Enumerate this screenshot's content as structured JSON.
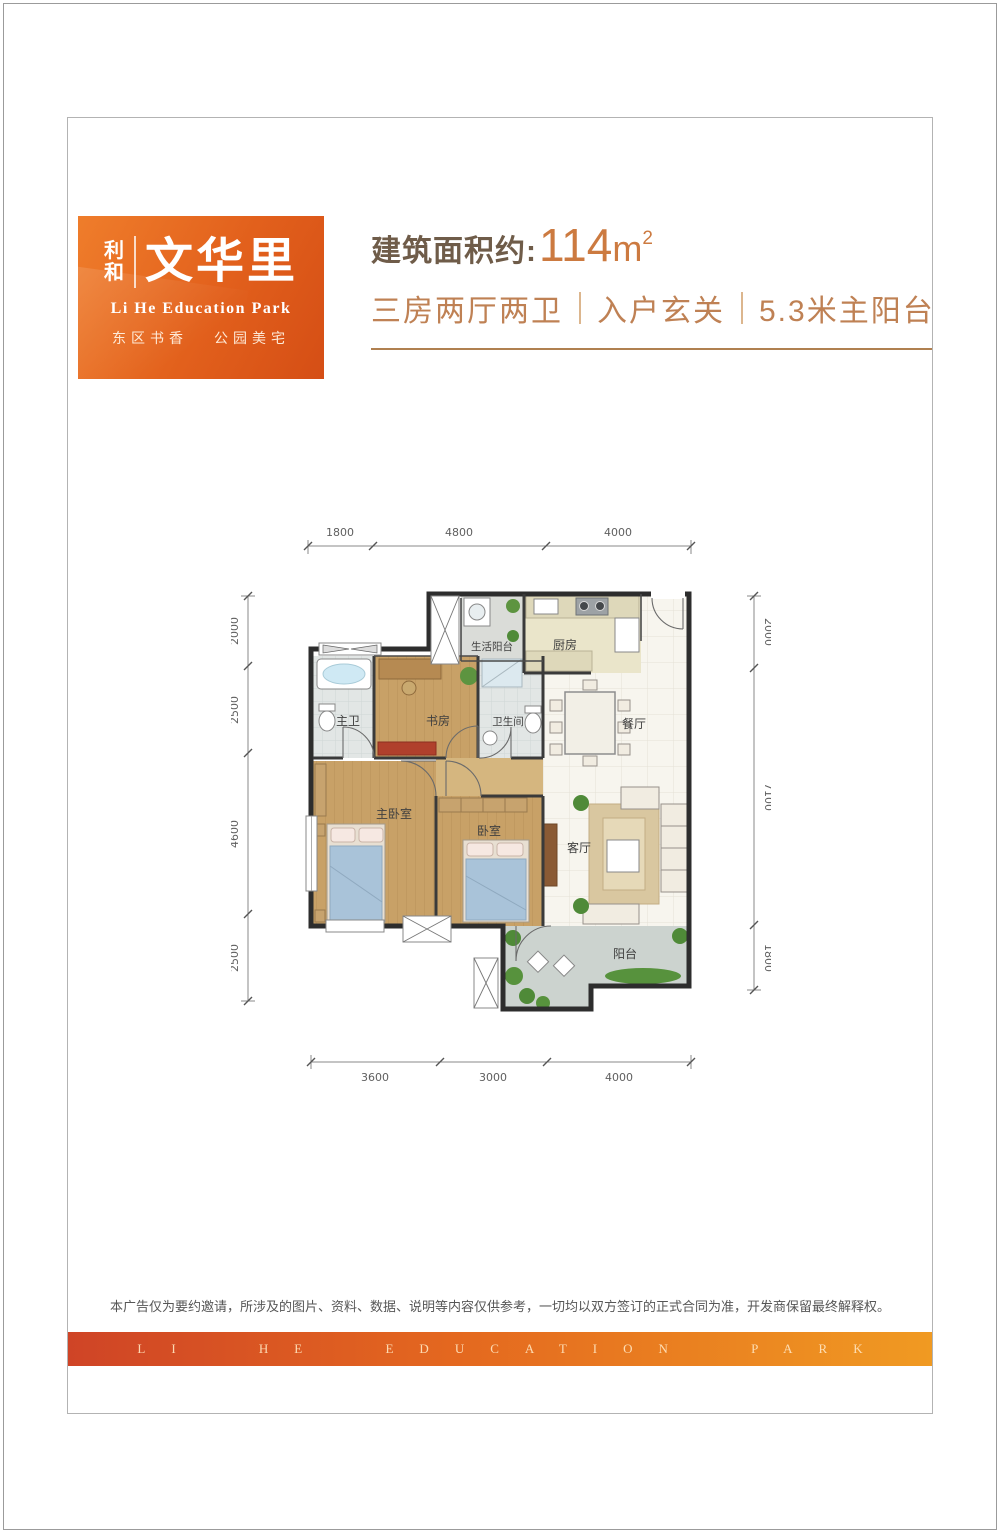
{
  "logo": {
    "prefix_chars": [
      "利",
      "和"
    ],
    "name": "文华里",
    "subtitle": "Li He Education Park",
    "tagline_left": "东区书香",
    "tagline_right": "公园美宅"
  },
  "header": {
    "area_label": "建筑面积约:",
    "area_value": "114",
    "area_unit_base": "m",
    "area_unit_sup": "2",
    "features": [
      "三房两厅两卫",
      "入户玄关",
      "5.3米主阳台"
    ]
  },
  "plan": {
    "rooms": {
      "service_balcony": "生活阳台",
      "kitchen": "厨房",
      "master_bath": "主卫",
      "study": "书房",
      "bathroom": "卫生间",
      "dining": "餐厅",
      "master_bedroom": "主卧室",
      "bedroom": "卧室",
      "living": "客厅",
      "balcony": "阳台"
    },
    "dims_top": [
      "1800",
      "4800",
      "4000"
    ],
    "dims_left": [
      "2000",
      "2500",
      "4600",
      "2500"
    ],
    "dims_right": [
      "2000",
      "7100",
      "1800"
    ],
    "dims_bottom": [
      "3600",
      "3000",
      "4000"
    ]
  },
  "footer": {
    "disclaimer": "本广告仅为要约邀请，所涉及的图片、资料、数据、说明等内容仅供参考，一切均以双方签订的正式合同为准，开发商保留最终解释权。",
    "banner": "LI HE EDUCATION PARK"
  },
  "colors": {
    "brand_orange": "#e2601c",
    "brand_orange_light": "#ef7d2b",
    "title_text": "#6f5c49",
    "area_number": "#cc7a40",
    "accent_text": "#bf8154",
    "rule_color": "#b08050",
    "banner_left": "#cf4426",
    "banner_right": "#f09a22"
  }
}
